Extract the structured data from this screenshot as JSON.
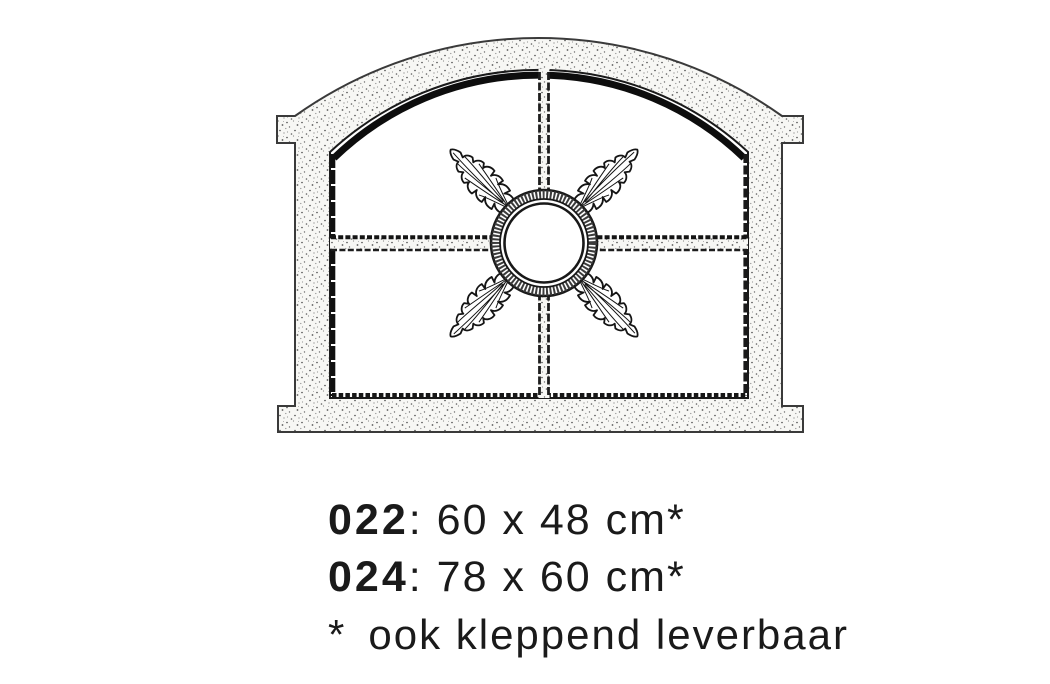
{
  "page": {
    "background_color": "#ffffff",
    "ink_color": "#1a1a1a"
  },
  "illustration": {
    "alt": "Technical line drawing of an arched cast-iron stable window: four panes divided by a cross muntin, central circular ring with four oak-leaf ornaments, stippled frame with side lugs and protruding sill"
  },
  "products": [
    {
      "code": "022",
      "separator": ": ",
      "size": "60 x 48 cm",
      "marker": "*"
    },
    {
      "code": "024",
      "separator": ": ",
      "size": "78 x 60 cm",
      "marker": "*"
    }
  ],
  "footnote": {
    "marker": "*",
    "text": "ook kleppend leverbaar"
  }
}
